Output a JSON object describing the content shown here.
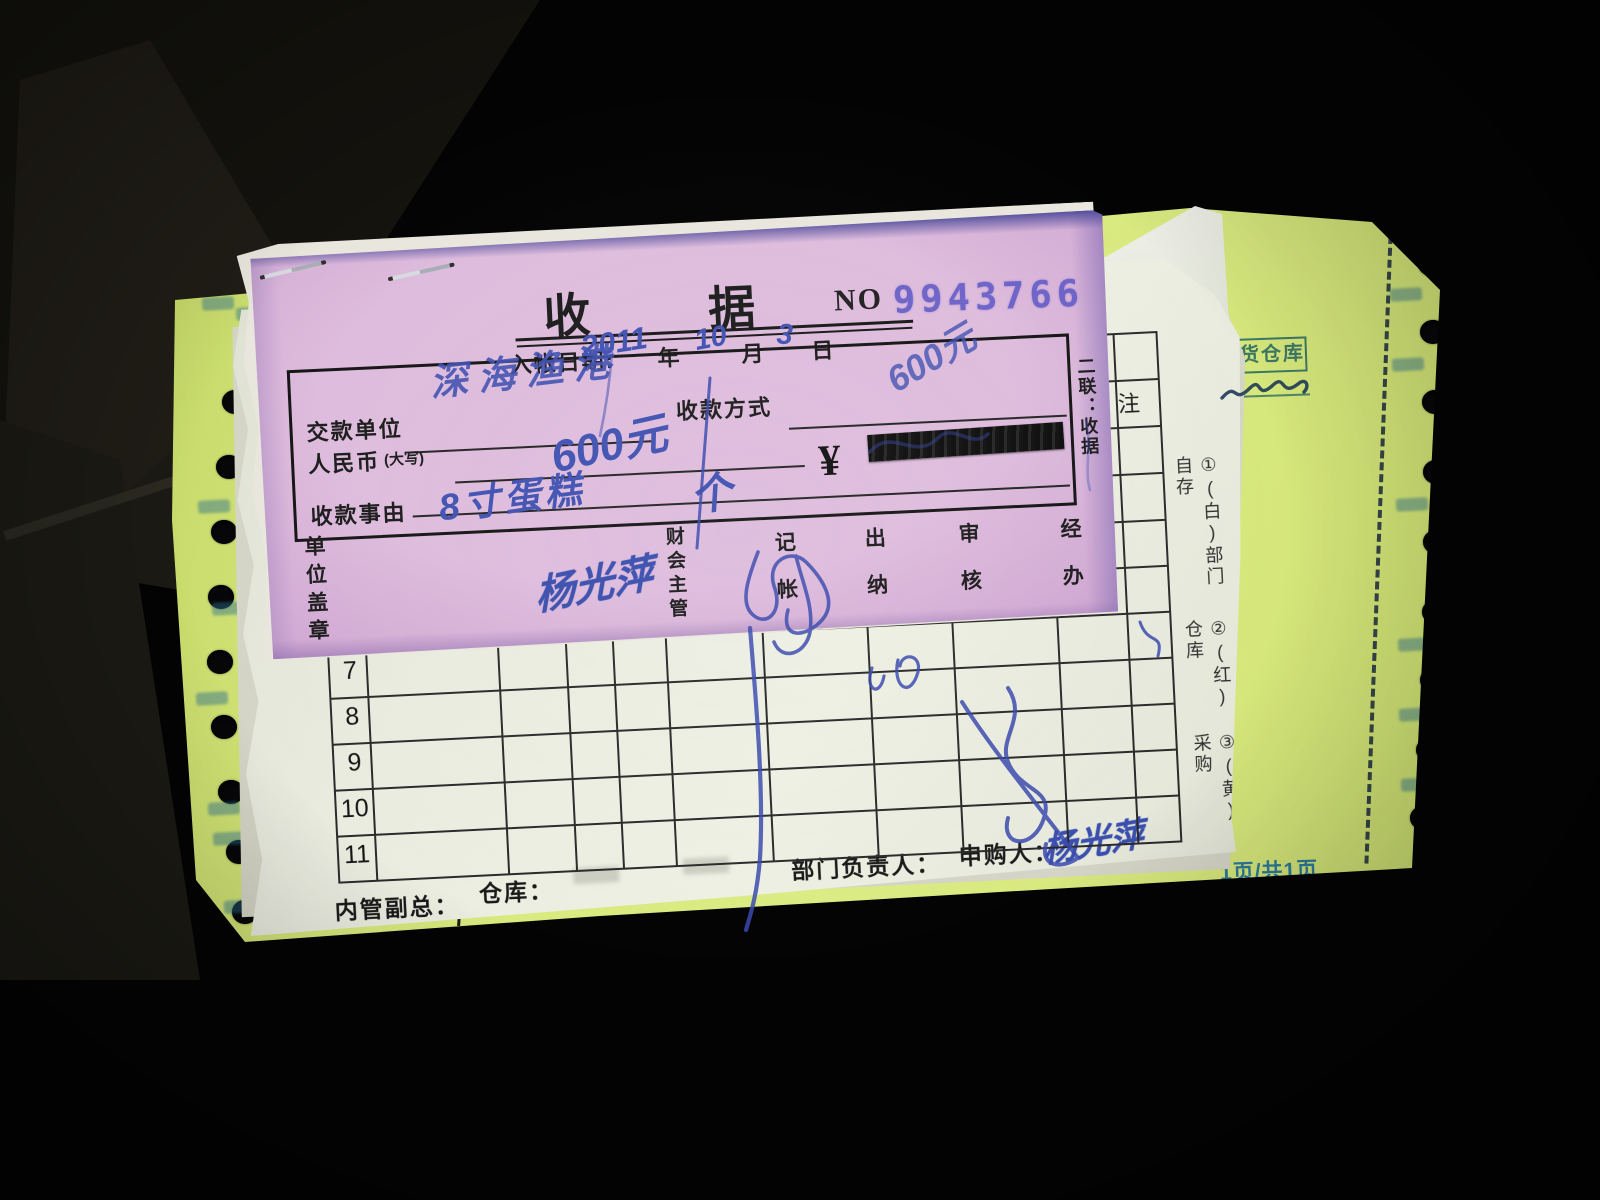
{
  "receipt": {
    "title": "收据",
    "no_label": "NO",
    "number": "9943766",
    "date": {
      "label": "入帐日期:",
      "year": "2011",
      "year_unit": "年",
      "month": "10",
      "month_unit": "月",
      "day": "3",
      "day_unit": "日"
    },
    "fields": {
      "payer_label": "交款单位",
      "payer_value": "深海渔港",
      "method_label": "收款方式",
      "method_value": "600元",
      "amount_label": "人民币",
      "amount_sub_label": "(大写)",
      "amount_value": "600元",
      "currency_symbol": "¥",
      "reason_label": "收款事由",
      "reason_value": "8寸蛋糕",
      "reason_value2": "个"
    },
    "copy_label": "二联：收据",
    "seal_label": "单位盖章",
    "signers": {
      "accounting_label": "财会主管",
      "accounting_signature": "杨光萍",
      "bookkeeper_label": "记帐",
      "cashier_label": "出纳",
      "auditor_label": "审核",
      "handler_label": "经办"
    }
  },
  "form": {
    "row_numbers": [
      "7",
      "8",
      "9",
      "10",
      "11"
    ],
    "remark_header": "注",
    "copy_notes": [
      "①(白)部门自存",
      "②(红)仓库",
      "③(黄)采购"
    ],
    "footer": {
      "deputy_label": "内管副总：",
      "warehouse_label": "仓库：",
      "dept_head_label": "部门负责人：",
      "requester_label": "申购人：",
      "requester_signature": "杨光萍"
    }
  },
  "yellow_sheet": {
    "stamp_text": "发货仓库",
    "page_text": "1页/共1页"
  },
  "colors": {
    "paper_pink": "#d9b7d8",
    "paper_yellow": "#d9e87e",
    "paper_white": "#eceade",
    "ink_blue": "#3b4fae",
    "stamp_teal": "#2e6e62",
    "number_purple": "#6e63c8"
  }
}
